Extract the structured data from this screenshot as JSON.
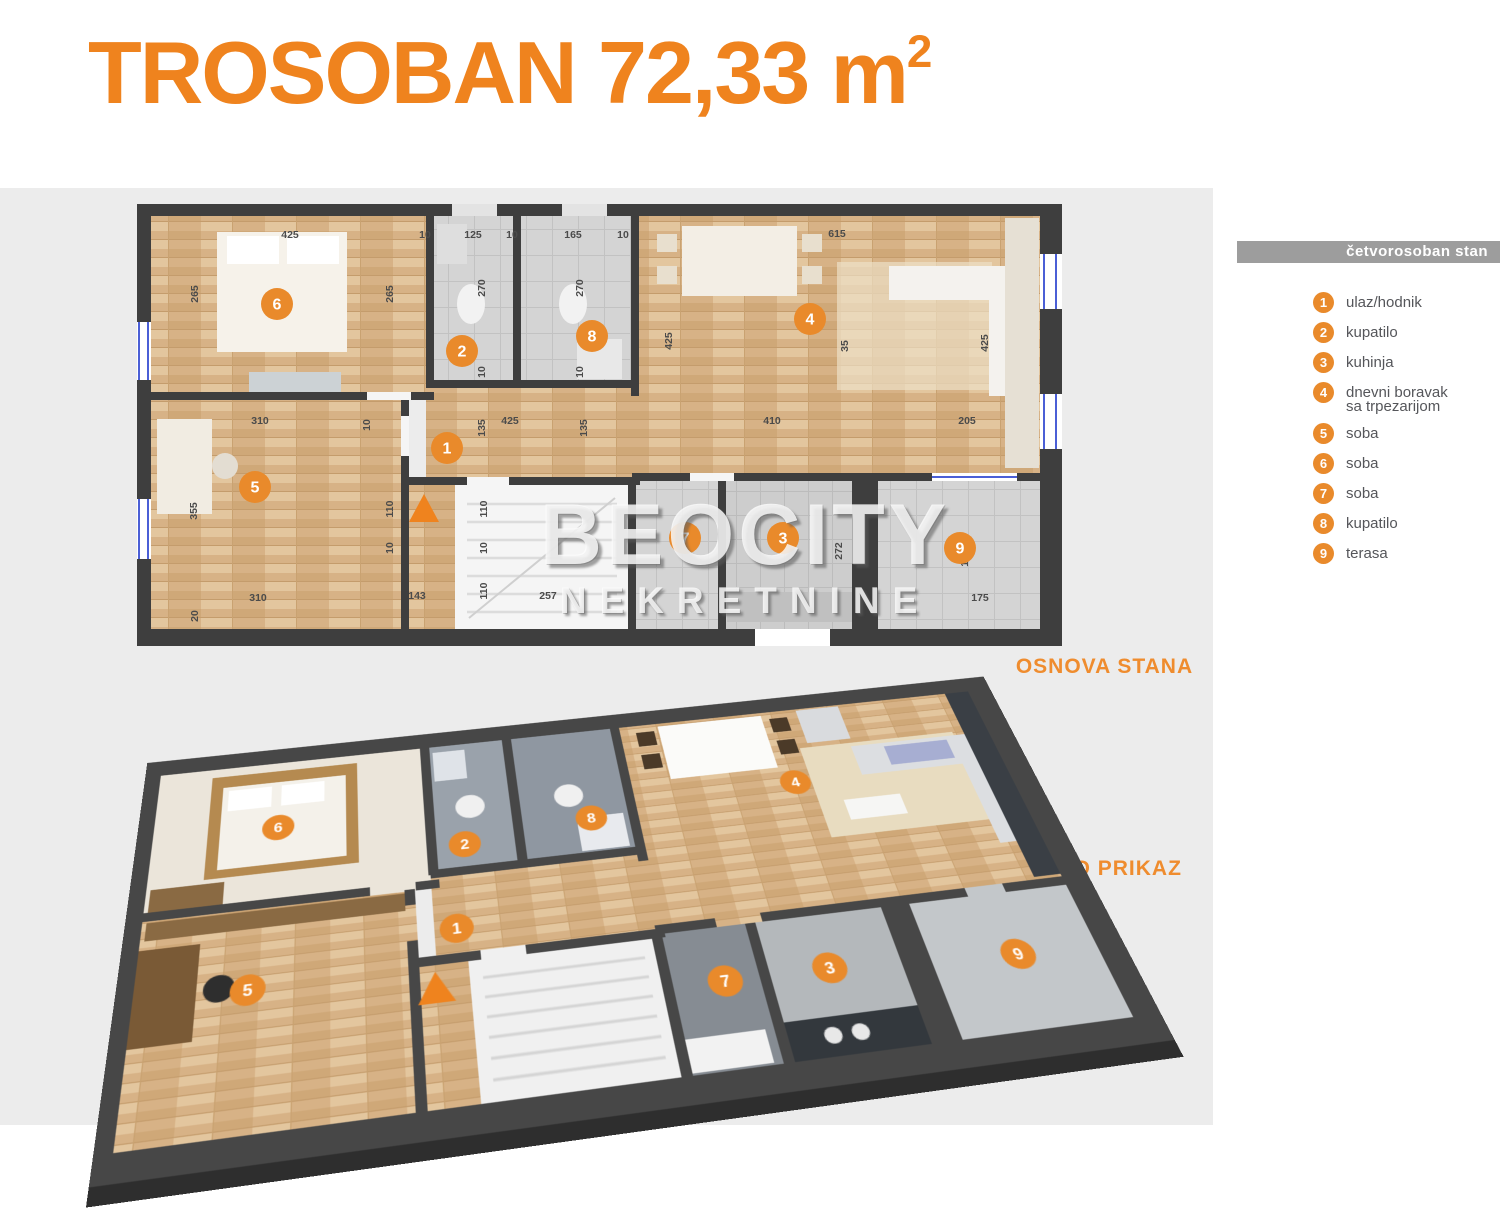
{
  "title": {
    "main": "TROSOBAN 72,33 m",
    "sup": "2"
  },
  "watermark": {
    "line1": "BEOCITY",
    "line2": "NEKRETNINE"
  },
  "section_labels": {
    "plan_2d": "OSNOVA STANA",
    "plan_3d": "3D PRIKAZ"
  },
  "colors": {
    "accent_orange": "#ef831e",
    "marker_orange": "#e98a2b",
    "legend_bar_gray": "#9d9d9d",
    "wall_dark": "#3e3e3e",
    "plan_background": "#ececec"
  },
  "legend": {
    "header": "četvorosoban stan",
    "items": [
      {
        "num": "1",
        "label": "ulaz/hodnik"
      },
      {
        "num": "2",
        "label": "kupatilo"
      },
      {
        "num": "3",
        "label": "kuhinja"
      },
      {
        "num": "4",
        "label": "dnevni boravak",
        "label2": "sa trpezarijom"
      },
      {
        "num": "5",
        "label": "soba"
      },
      {
        "num": "6",
        "label": "soba"
      },
      {
        "num": "7",
        "label": "soba"
      },
      {
        "num": "8",
        "label": "kupatilo"
      },
      {
        "num": "9",
        "label": "terasa"
      }
    ]
  },
  "plan2d": {
    "markers": [
      {
        "n": "1",
        "x": 310,
        "y": 244
      },
      {
        "n": "2",
        "x": 325,
        "y": 147
      },
      {
        "n": "3",
        "x": 646,
        "y": 334
      },
      {
        "n": "4",
        "x": 673,
        "y": 115
      },
      {
        "n": "5",
        "x": 118,
        "y": 283
      },
      {
        "n": "6",
        "x": 140,
        "y": 100
      },
      {
        "n": "7",
        "x": 548,
        "y": 334
      },
      {
        "n": "8",
        "x": 455,
        "y": 132
      },
      {
        "n": "9",
        "x": 823,
        "y": 344
      }
    ],
    "dims": [
      {
        "t": "425",
        "x": 153,
        "y": 34,
        "r": 0
      },
      {
        "t": "10",
        "x": 288,
        "y": 34,
        "r": 0
      },
      {
        "t": "125",
        "x": 336,
        "y": 34,
        "r": 0
      },
      {
        "t": "10",
        "x": 375,
        "y": 34,
        "r": 0
      },
      {
        "t": "165",
        "x": 436,
        "y": 34,
        "r": 0
      },
      {
        "t": "10",
        "x": 486,
        "y": 34,
        "r": 0
      },
      {
        "t": "615",
        "x": 700,
        "y": 33,
        "r": 0
      },
      {
        "t": "265",
        "x": 61,
        "y": 90,
        "r": 1
      },
      {
        "t": "265",
        "x": 256,
        "y": 90,
        "r": 1
      },
      {
        "t": "270",
        "x": 348,
        "y": 84,
        "r": 1
      },
      {
        "t": "270",
        "x": 446,
        "y": 84,
        "r": 1
      },
      {
        "t": "10",
        "x": 348,
        "y": 168,
        "r": 1
      },
      {
        "t": "10",
        "x": 446,
        "y": 168,
        "r": 1
      },
      {
        "t": "425",
        "x": 535,
        "y": 137,
        "r": 1
      },
      {
        "t": "35",
        "x": 711,
        "y": 142,
        "r": 1
      },
      {
        "t": "425",
        "x": 851,
        "y": 139,
        "r": 1
      },
      {
        "t": "410",
        "x": 635,
        "y": 220,
        "r": 0
      },
      {
        "t": "205",
        "x": 830,
        "y": 220,
        "r": 0
      },
      {
        "t": "310",
        "x": 123,
        "y": 220,
        "r": 0
      },
      {
        "t": "10",
        "x": 233,
        "y": 221,
        "r": 1
      },
      {
        "t": "135",
        "x": 348,
        "y": 224,
        "r": 1
      },
      {
        "t": "425",
        "x": 373,
        "y": 220,
        "r": 0
      },
      {
        "t": "135",
        "x": 450,
        "y": 224,
        "r": 1
      },
      {
        "t": "355",
        "x": 60,
        "y": 307,
        "r": 1
      },
      {
        "t": "310",
        "x": 121,
        "y": 397,
        "r": 0
      },
      {
        "t": "20",
        "x": 61,
        "y": 412,
        "r": 1
      },
      {
        "t": "110",
        "x": 256,
        "y": 305,
        "r": 1
      },
      {
        "t": "110",
        "x": 350,
        "y": 305,
        "r": 1
      },
      {
        "t": "10",
        "x": 256,
        "y": 344,
        "r": 1
      },
      {
        "t": "10",
        "x": 350,
        "y": 344,
        "r": 1
      },
      {
        "t": "143",
        "x": 280,
        "y": 395,
        "r": 0
      },
      {
        "t": "110",
        "x": 350,
        "y": 387,
        "r": 1
      },
      {
        "t": "257",
        "x": 411,
        "y": 395,
        "r": 0
      },
      {
        "t": "272",
        "x": 705,
        "y": 347,
        "r": 1
      },
      {
        "t": "195",
        "x": 831,
        "y": 354,
        "r": 1
      },
      {
        "t": "175",
        "x": 843,
        "y": 397,
        "r": 0
      }
    ]
  },
  "plan3d": {
    "markers": [
      {
        "n": "1",
        "x": 310,
        "y": 244
      },
      {
        "n": "2",
        "x": 325,
        "y": 147
      },
      {
        "n": "3",
        "x": 646,
        "y": 334
      },
      {
        "n": "4",
        "x": 673,
        "y": 115
      },
      {
        "n": "5",
        "x": 118,
        "y": 283
      },
      {
        "n": "6",
        "x": 140,
        "y": 100
      },
      {
        "n": "7",
        "x": 548,
        "y": 334
      },
      {
        "n": "8",
        "x": 455,
        "y": 132
      },
      {
        "n": "9",
        "x": 823,
        "y": 344
      }
    ]
  }
}
